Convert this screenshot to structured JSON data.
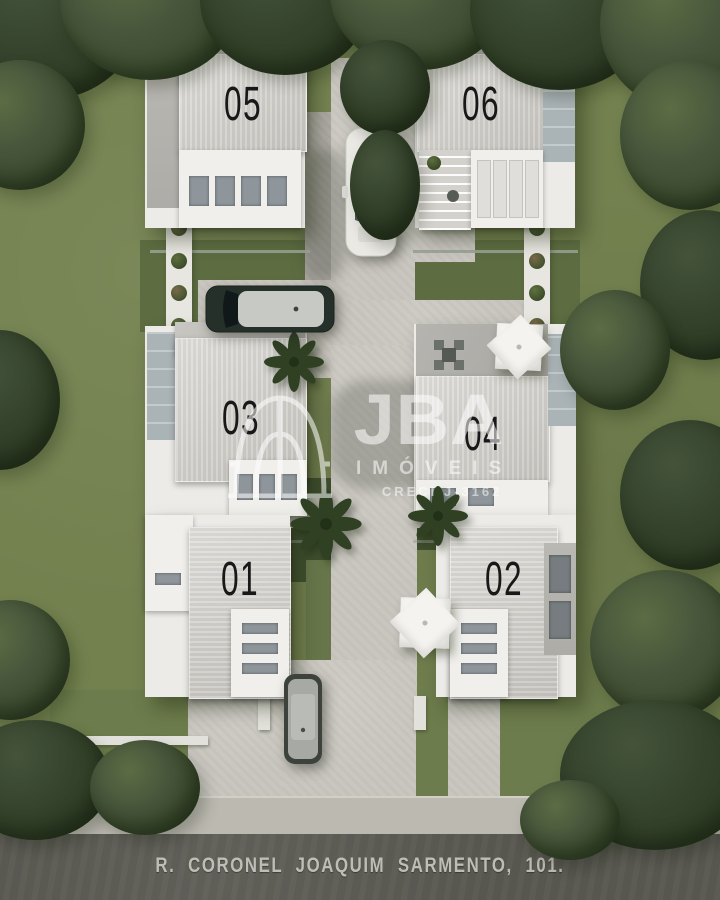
{
  "houses": [
    {
      "number": "05"
    },
    {
      "number": "06"
    },
    {
      "number": "03"
    },
    {
      "number": "04"
    },
    {
      "number": "01"
    },
    {
      "number": "02"
    }
  ],
  "watermark": {
    "brand": "JBA",
    "subtitle": "IMÓVEIS",
    "license": "CRECI J-3162"
  },
  "street": {
    "label": "R. CORONEL JOAQUIM SARMENTO, 101."
  },
  "objects": [
    "white-sports-car",
    "dark-suv",
    "parked-gray-car",
    "palm-tree",
    "patio-umbrella",
    "outdoor-dining-set",
    "planter-bushes",
    "dome-arch-icon"
  ],
  "colors": {
    "grass": "#73814f",
    "grass_dark": "#4e5d37",
    "tree": "#3d4c30",
    "tree_dark": "#2c3a24",
    "concrete": "#c9c6bf",
    "concrete_dark": "#aeaba4",
    "sidewalk": "#bcb9b1",
    "asphalt": "#57564f",
    "roof_light": "#d7d5d0",
    "roof_mid": "#c2c0bb",
    "roof_white": "#f0efec",
    "skylight": "#8e969b",
    "number": "#181818",
    "street_text": "#cac8c1",
    "watermark": "#ffffff"
  }
}
